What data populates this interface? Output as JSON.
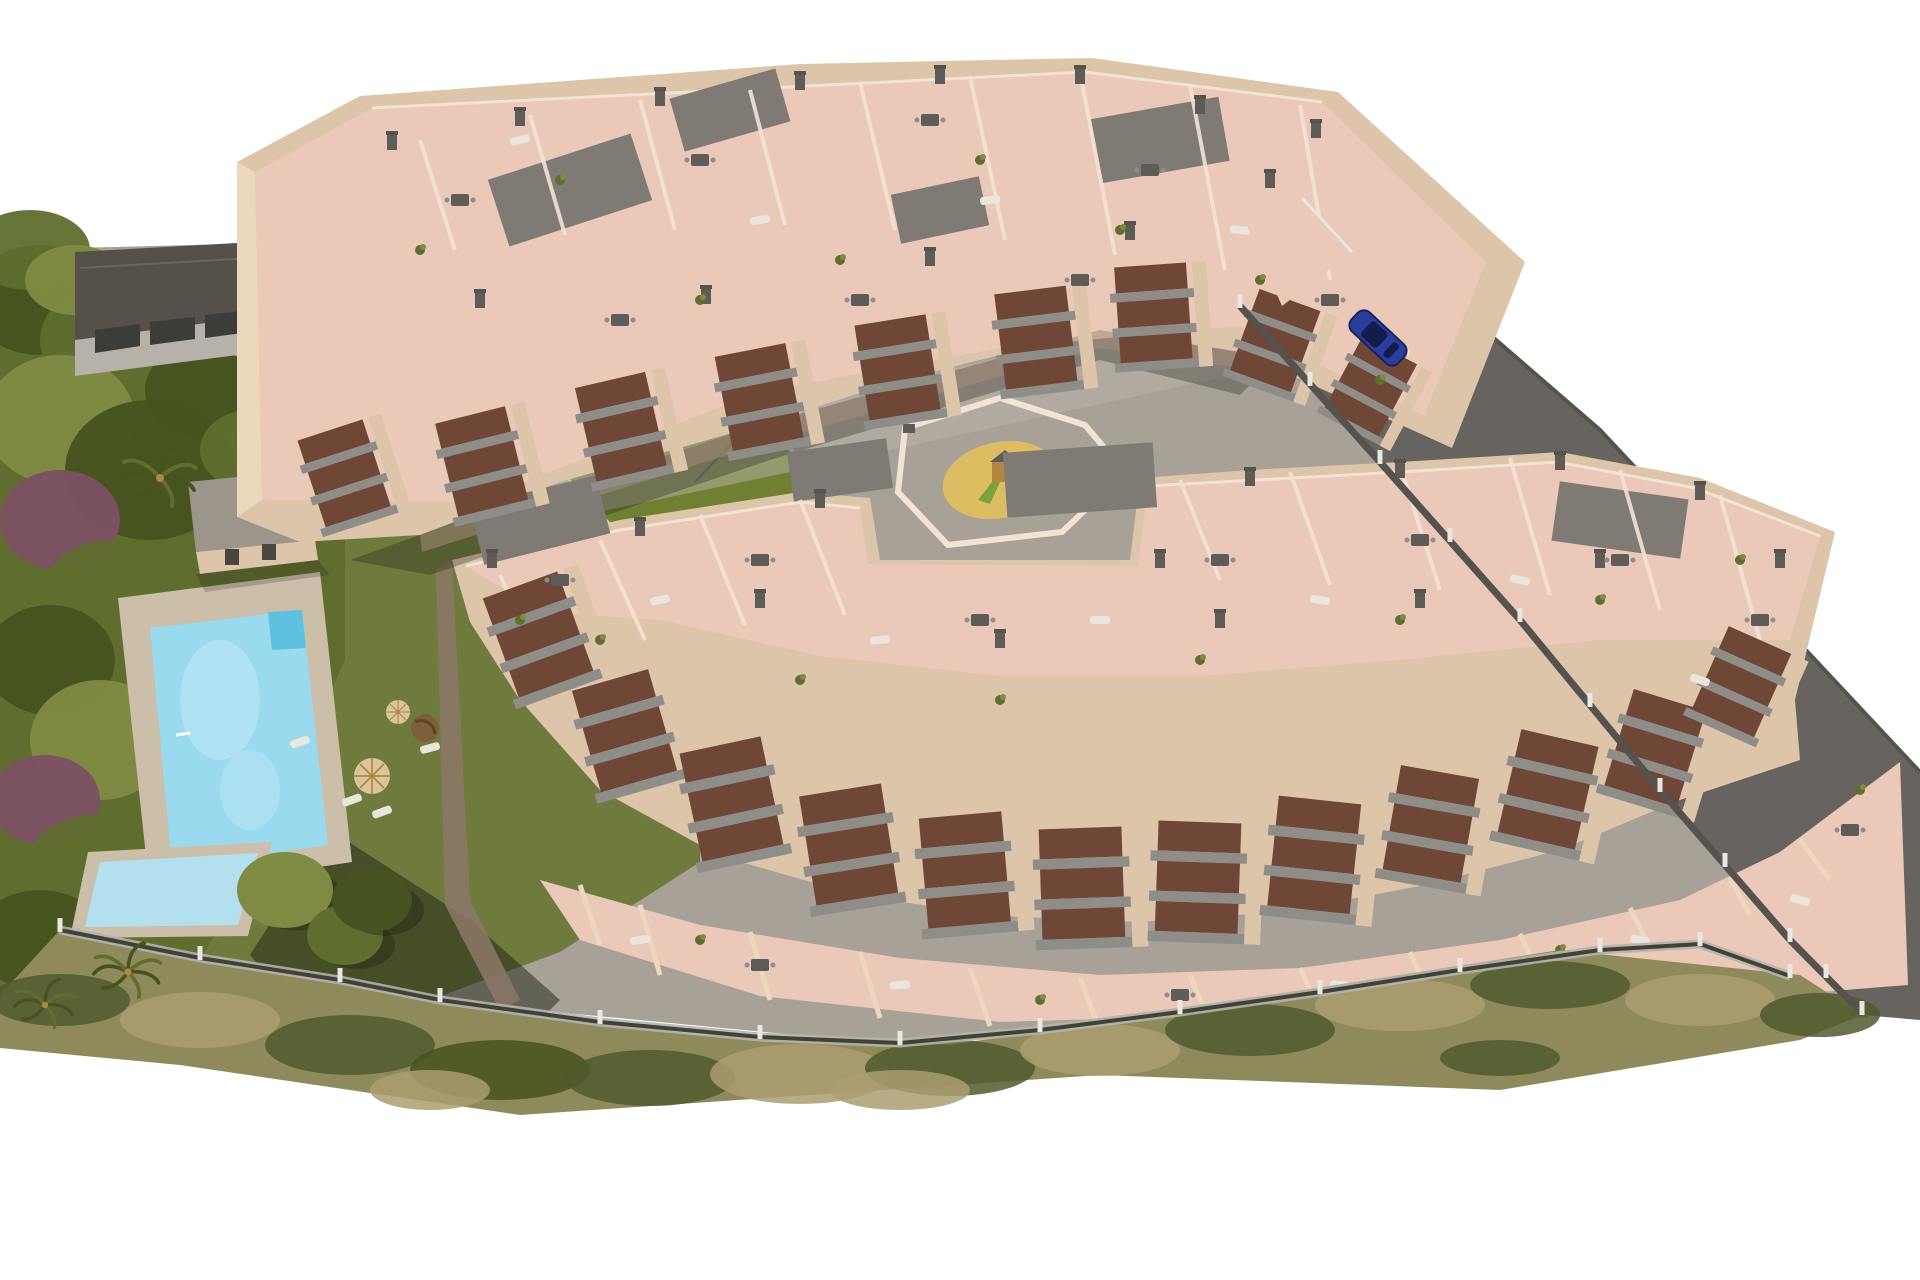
{
  "palette": {
    "bg": "#ffffff",
    "road": "#67635e",
    "road_edge": "#56524e",
    "pavement": "#a7a198",
    "pavement_light": "#bab3a7",
    "wall": "#dcc5a8",
    "wall_lit": "#ecd9bd",
    "wall_shadow": "#a28b79",
    "wall_dark": "#8c7867",
    "roof_pink": "#eac9b8",
    "parapet": "#f3e3d3",
    "roof_gray": "#7f7a73",
    "balcony_gray": "#8f8d88",
    "balcony_dark": "#6f4737",
    "chimney": "#5f5b56",
    "lawn": "#6f7b3d",
    "tree_dark": "#46521f",
    "tree_mid": "#5f6e2e",
    "tree_light": "#7f8b42",
    "tree_purple": "#7b5063",
    "scrub_base": "#8f8a5c",
    "scrub_dark": "#4f5a2d",
    "scrub_tan": "#ab9e71",
    "pool_deck": "#cbbfa9",
    "pool_water": "#9adaee",
    "pool_water_deep": "#5ec1e0",
    "kids_pool": "#b4dfee",
    "fence_post": "#e9e7e1",
    "fence_dark": "#3f423a",
    "neighbor_roof": "#55504a",
    "neighbor_wall": "#b6b2a9",
    "court_green": "#6f8033",
    "court_line": "#dfe6c8",
    "glass": "#cfe3dd",
    "sand": "#dcbd62",
    "wood": "#b3863f",
    "slide_green": "#7da23c",
    "car_body": "#2c3e9d",
    "car_glass": "#141c4e",
    "umbrella": "#d8c69c",
    "furniture_white": "#eae6dc",
    "egg_chair": "#7d5f3a"
  },
  "scene": {
    "trees": [
      {
        "x": 40,
        "y": 300,
        "rx": 70,
        "ry": 55,
        "c": "tree_dark"
      },
      {
        "x": 120,
        "y": 340,
        "rx": 80,
        "ry": 60,
        "c": "tree_mid"
      },
      {
        "x": 60,
        "y": 420,
        "rx": 75,
        "ry": 65,
        "c": "tree_light"
      },
      {
        "x": 150,
        "y": 470,
        "rx": 85,
        "ry": 70,
        "c": "tree_dark"
      },
      {
        "x": 60,
        "y": 520,
        "rx": 60,
        "ry": 50,
        "c": "tree_purple"
      },
      {
        "x": 110,
        "y": 600,
        "rx": 70,
        "ry": 60,
        "c": "tree_mid"
      },
      {
        "x": 50,
        "y": 660,
        "rx": 65,
        "ry": 55,
        "c": "tree_dark"
      },
      {
        "x": 100,
        "y": 740,
        "rx": 70,
        "ry": 60,
        "c": "tree_light"
      },
      {
        "x": 45,
        "y": 800,
        "rx": 55,
        "ry": 45,
        "c": "tree_purple"
      },
      {
        "x": 95,
        "y": 870,
        "rx": 70,
        "ry": 55,
        "c": "tree_mid"
      },
      {
        "x": 40,
        "y": 940,
        "rx": 65,
        "ry": 50,
        "c": "tree_dark"
      },
      {
        "x": 120,
        "y": 960,
        "rx": 55,
        "ry": 40,
        "c": "tree_mid"
      },
      {
        "x": 200,
        "y": 390,
        "rx": 55,
        "ry": 45,
        "c": "tree_dark"
      },
      {
        "x": 250,
        "y": 450,
        "rx": 50,
        "ry": 40,
        "c": "tree_mid"
      },
      {
        "x": 30,
        "y": 250,
        "rx": 60,
        "ry": 40,
        "c": "tree_mid"
      },
      {
        "x": 75,
        "y": 280,
        "rx": 50,
        "ry": 35,
        "c": "tree_light"
      }
    ],
    "garden_trees": [
      {
        "x": 285,
        "y": 890,
        "rx": 48,
        "ry": 38,
        "c": "tree_light"
      },
      {
        "x": 345,
        "y": 935,
        "rx": 38,
        "ry": 30,
        "c": "tree_mid"
      },
      {
        "x": 372,
        "y": 900,
        "rx": 40,
        "ry": 32,
        "c": "tree_dark"
      }
    ],
    "palms": [
      {
        "x": 160,
        "y": 478,
        "s": 1.0
      },
      {
        "x": 128,
        "y": 972,
        "s": 0.9
      },
      {
        "x": 45,
        "y": 1005,
        "s": 0.8
      }
    ],
    "scrub": [
      {
        "x": 60,
        "y": 1000,
        "rx": 70,
        "ry": 26,
        "c": "scrub_dark"
      },
      {
        "x": 200,
        "y": 1020,
        "rx": 80,
        "ry": 28,
        "c": "scrub_tan"
      },
      {
        "x": 350,
        "y": 1045,
        "rx": 85,
        "ry": 30,
        "c": "scrub_dark"
      },
      {
        "x": 500,
        "y": 1070,
        "rx": 90,
        "ry": 30,
        "c": "tree_dark"
      },
      {
        "x": 650,
        "y": 1078,
        "rx": 85,
        "ry": 28,
        "c": "scrub_dark"
      },
      {
        "x": 800,
        "y": 1074,
        "rx": 90,
        "ry": 30,
        "c": "scrub_tan"
      },
      {
        "x": 950,
        "y": 1068,
        "rx": 85,
        "ry": 28,
        "c": "scrub_dark"
      },
      {
        "x": 1100,
        "y": 1050,
        "rx": 80,
        "ry": 26,
        "c": "scrub_tan"
      },
      {
        "x": 1250,
        "y": 1030,
        "rx": 85,
        "ry": 26,
        "c": "scrub_dark"
      },
      {
        "x": 1400,
        "y": 1005,
        "rx": 85,
        "ry": 26,
        "c": "scrub_tan"
      },
      {
        "x": 1550,
        "y": 985,
        "rx": 80,
        "ry": 24,
        "c": "scrub_dark"
      },
      {
        "x": 1700,
        "y": 1000,
        "rx": 75,
        "ry": 26,
        "c": "scrub_tan"
      },
      {
        "x": 1820,
        "y": 1015,
        "rx": 60,
        "ry": 22,
        "c": "scrub_dark"
      },
      {
        "x": 430,
        "y": 1090,
        "rx": 60,
        "ry": 20,
        "c": "scrub_tan"
      },
      {
        "x": 900,
        "y": 1090,
        "rx": 70,
        "ry": 20,
        "c": "scrub_tan"
      },
      {
        "x": 1500,
        "y": 1058,
        "rx": 60,
        "ry": 18,
        "c": "scrub_dark"
      }
    ],
    "fence_posts": [
      [
        60,
        930
      ],
      [
        200,
        958
      ],
      [
        340,
        980
      ],
      [
        440,
        1000
      ],
      [
        600,
        1022
      ],
      [
        760,
        1037
      ],
      [
        900,
        1043
      ],
      [
        1040,
        1030
      ],
      [
        1180,
        1012
      ],
      [
        1320,
        992
      ],
      [
        1460,
        970
      ],
      [
        1600,
        950
      ],
      [
        1700,
        944
      ],
      [
        1790,
        976
      ]
    ],
    "road_posts": [
      [
        1240,
        306
      ],
      [
        1310,
        384
      ],
      [
        1380,
        462
      ],
      [
        1450,
        540
      ],
      [
        1520,
        620
      ],
      [
        1590,
        705
      ],
      [
        1660,
        790
      ],
      [
        1725,
        865
      ],
      [
        1790,
        940
      ],
      [
        1826,
        976
      ],
      [
        1862,
        1013
      ]
    ],
    "gate_posts": [
      [
        300,
        305
      ],
      [
        340,
        302
      ],
      [
        380,
        300
      ],
      [
        420,
        298
      ],
      [
        458,
        296
      ]
    ],
    "stacks_upper": [
      {
        "x": 330,
        "y": 430,
        "r": -18,
        "s": 0.95
      },
      {
        "x": 470,
        "y": 415,
        "r": -14,
        "s": 1
      },
      {
        "x": 610,
        "y": 380,
        "r": -13,
        "s": 1
      },
      {
        "x": 750,
        "y": 350,
        "r": -11,
        "s": 1
      },
      {
        "x": 890,
        "y": 320,
        "r": -9,
        "s": 1
      },
      {
        "x": 1030,
        "y": 290,
        "r": -7,
        "s": 1
      },
      {
        "x": 1150,
        "y": 265,
        "r": -4,
        "s": 1
      },
      {
        "x": 1290,
        "y": 300,
        "r": 20,
        "s": 0.9
      },
      {
        "x": 1390,
        "y": 350,
        "r": 28,
        "s": 0.85
      }
    ],
    "stacks_lower": [
      {
        "x": 520,
        "y": 585,
        "r": -20,
        "s": 1.1
      },
      {
        "x": 610,
        "y": 680,
        "r": -16,
        "s": 1.1
      },
      {
        "x": 720,
        "y": 745,
        "r": -12,
        "s": 1.15
      },
      {
        "x": 840,
        "y": 790,
        "r": -9,
        "s": 1.15
      },
      {
        "x": 960,
        "y": 815,
        "r": -5,
        "s": 1.15
      },
      {
        "x": 1080,
        "y": 828,
        "r": -2,
        "s": 1.15
      },
      {
        "x": 1200,
        "y": 822,
        "r": 2,
        "s": 1.15
      },
      {
        "x": 1320,
        "y": 800,
        "r": 6,
        "s": 1.15
      },
      {
        "x": 1440,
        "y": 772,
        "r": 10,
        "s": 1.1
      },
      {
        "x": 1560,
        "y": 738,
        "r": 13,
        "s": 1.1
      },
      {
        "x": 1670,
        "y": 700,
        "r": 17,
        "s": 1.05
      },
      {
        "x": 1760,
        "y": 640,
        "r": 24,
        "s": 0.95
      }
    ],
    "chimneys": [
      [
        392,
        142
      ],
      [
        520,
        118
      ],
      [
        660,
        98
      ],
      [
        800,
        82
      ],
      [
        940,
        76
      ],
      [
        1080,
        76
      ],
      [
        1200,
        106
      ],
      [
        1316,
        130
      ],
      [
        480,
        300
      ],
      [
        706,
        296
      ],
      [
        930,
        258
      ],
      [
        1130,
        232
      ],
      [
        1270,
        180
      ],
      [
        492,
        560
      ],
      [
        640,
        528
      ],
      [
        820,
        500
      ],
      [
        1160,
        560
      ],
      [
        1250,
        478
      ],
      [
        1400,
        470
      ],
      [
        1560,
        462
      ],
      [
        1700,
        492
      ],
      [
        560,
        620
      ],
      [
        760,
        600
      ],
      [
        1000,
        640
      ],
      [
        1220,
        620
      ],
      [
        1420,
        600
      ],
      [
        1600,
        560
      ],
      [
        1780,
        560
      ]
    ],
    "roof_patches": [
      {
        "x": 570,
        "y": 190,
        "w": 150,
        "h": 70,
        "r": -18
      },
      {
        "x": 730,
        "y": 110,
        "w": 110,
        "h": 55,
        "r": -16
      },
      {
        "x": 1160,
        "y": 140,
        "w": 130,
        "h": 65,
        "r": -10
      },
      {
        "x": 940,
        "y": 210,
        "w": 90,
        "h": 50,
        "r": -12
      },
      {
        "x": 540,
        "y": 520,
        "w": 130,
        "h": 60,
        "r": -14
      },
      {
        "x": 1080,
        "y": 480,
        "w": 150,
        "h": 65,
        "r": -4
      },
      {
        "x": 1620,
        "y": 520,
        "w": 130,
        "h": 60,
        "r": 8
      },
      {
        "x": 840,
        "y": 470,
        "w": 100,
        "h": 50,
        "r": -8
      }
    ],
    "roof_dividers": [
      [
        420,
        140,
        455,
        250
      ],
      [
        530,
        115,
        565,
        235
      ],
      [
        640,
        100,
        675,
        230
      ],
      [
        750,
        90,
        785,
        225
      ],
      [
        860,
        82,
        895,
        230
      ],
      [
        970,
        76,
        1005,
        240
      ],
      [
        1080,
        72,
        1115,
        255
      ],
      [
        1190,
        85,
        1225,
        270
      ],
      [
        1300,
        105,
        1330,
        280
      ],
      [
        500,
        575,
        540,
        660
      ],
      [
        600,
        540,
        645,
        640
      ],
      [
        700,
        515,
        745,
        625
      ],
      [
        800,
        500,
        845,
        615
      ],
      [
        1180,
        480,
        1220,
        580
      ],
      [
        1290,
        472,
        1330,
        585
      ],
      [
        1400,
        465,
        1440,
        590
      ],
      [
        1510,
        458,
        1550,
        595
      ],
      [
        1620,
        470,
        1660,
        610
      ],
      [
        1720,
        495,
        1760,
        640
      ]
    ],
    "terrace_walls": [
      [
        580,
        885,
        600,
        945
      ],
      [
        640,
        905,
        660,
        975
      ],
      [
        750,
        932,
        770,
        1000
      ],
      [
        860,
        952,
        880,
        1018
      ],
      [
        970,
        968,
        990,
        1026
      ],
      [
        1080,
        978,
        1100,
        1030
      ],
      [
        1190,
        976,
        1210,
        1022
      ],
      [
        1300,
        968,
        1320,
        1012
      ],
      [
        1410,
        952,
        1430,
        996
      ],
      [
        1520,
        934,
        1540,
        976
      ],
      [
        1630,
        908,
        1650,
        948
      ],
      [
        1730,
        878,
        1750,
        915
      ],
      [
        1800,
        840,
        1830,
        880
      ]
    ],
    "tables": [
      [
        460,
        200
      ],
      [
        700,
        160
      ],
      [
        930,
        120
      ],
      [
        1150,
        170
      ],
      [
        1330,
        300
      ],
      [
        620,
        320
      ],
      [
        860,
        300
      ],
      [
        1080,
        280
      ],
      [
        560,
        580
      ],
      [
        760,
        560
      ],
      [
        980,
        620
      ],
      [
        1220,
        560
      ],
      [
        1420,
        540
      ],
      [
        1620,
        560
      ],
      [
        1760,
        620
      ],
      [
        760,
        965
      ],
      [
        1180,
        995
      ],
      [
        1500,
        970
      ],
      [
        1850,
        830
      ]
    ],
    "loungers": [
      {
        "x": 520,
        "y": 140,
        "r": -15
      },
      {
        "x": 760,
        "y": 220,
        "r": -10
      },
      {
        "x": 990,
        "y": 200,
        "r": -8
      },
      {
        "x": 1240,
        "y": 230,
        "r": 5
      },
      {
        "x": 1400,
        "y": 350,
        "r": 20
      },
      {
        "x": 660,
        "y": 600,
        "r": -12
      },
      {
        "x": 880,
        "y": 640,
        "r": -6
      },
      {
        "x": 1100,
        "y": 620,
        "r": 0
      },
      {
        "x": 1320,
        "y": 600,
        "r": 8
      },
      {
        "x": 1520,
        "y": 580,
        "r": 12
      },
      {
        "x": 1700,
        "y": 680,
        "r": 18
      },
      {
        "x": 640,
        "y": 940,
        "r": -8
      },
      {
        "x": 900,
        "y": 985,
        "r": -4
      },
      {
        "x": 1340,
        "y": 985,
        "r": 6
      },
      {
        "x": 1640,
        "y": 940,
        "r": 12
      },
      {
        "x": 1800,
        "y": 900,
        "r": 16
      },
      {
        "x": 352,
        "y": 800,
        "r": -20
      },
      {
        "x": 382,
        "y": 812,
        "r": -20
      },
      {
        "x": 430,
        "y": 748,
        "r": -15
      },
      {
        "x": 300,
        "y": 742,
        "r": -18
      }
    ],
    "plants": [
      [
        420,
        250
      ],
      [
        560,
        180
      ],
      [
        700,
        300
      ],
      [
        840,
        260
      ],
      [
        980,
        160
      ],
      [
        1120,
        230
      ],
      [
        1260,
        280
      ],
      [
        1380,
        380
      ],
      [
        600,
        640
      ],
      [
        800,
        680
      ],
      [
        1000,
        700
      ],
      [
        1200,
        660
      ],
      [
        1400,
        620
      ],
      [
        1600,
        600
      ],
      [
        1740,
        560
      ],
      [
        520,
        620
      ],
      [
        700,
        940
      ],
      [
        1040,
        1000
      ],
      [
        1560,
        950
      ],
      [
        1860,
        790
      ]
    ],
    "parasols": [
      {
        "x": 398,
        "y": 712,
        "s": 0.8
      },
      {
        "x": 372,
        "y": 776,
        "s": 1.2
      }
    ],
    "car": {
      "x": 1378,
      "y": 338,
      "rotate": 43
    }
  }
}
